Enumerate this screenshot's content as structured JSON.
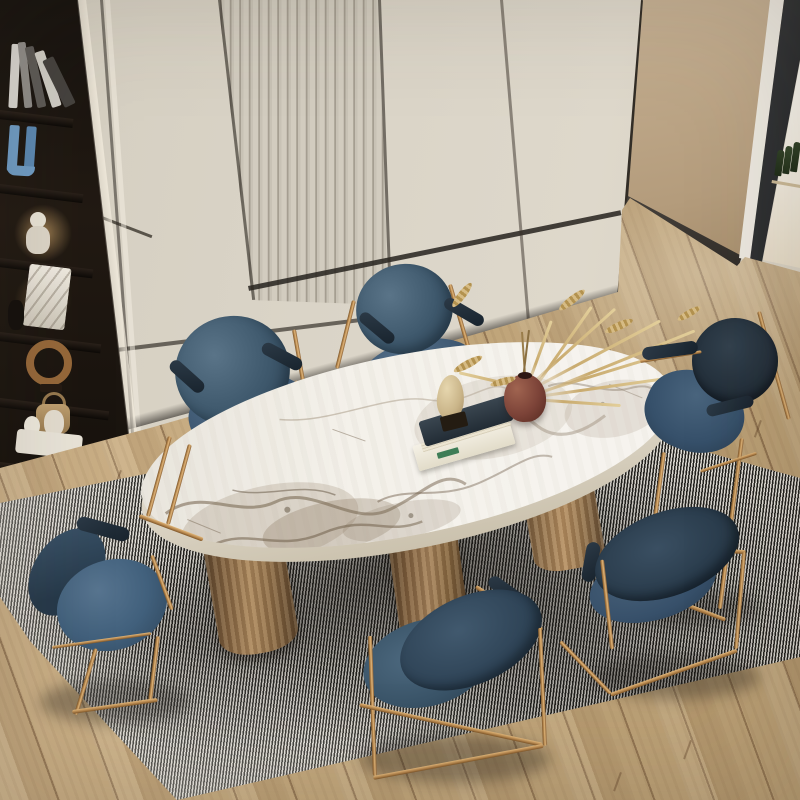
{
  "meta": {
    "title": "Dining room with oval marble table, brass-framed blue velvet chairs, striped rug and cream cabinetry",
    "width": 800,
    "height": 800
  },
  "palette": {
    "cream_cabinet": "#d8d2c5",
    "fluted_light": "#d2ccbf",
    "fluted_dark": "#aaa396",
    "tan_wall": "#bfa789",
    "seam_dark": "#26221d",
    "wood_floor": "#c3a87d",
    "wood_seam": "#604228",
    "rug_light": "#e2dfd8",
    "rug_dark": "#24231f",
    "marble": "#f2efe8",
    "marble_vein": "#8d7b63",
    "brass": "#b5854c",
    "velvet_blue": "#3e586c",
    "velvet_navy": "#232f3a",
    "bronze_leg": "#8a6a45",
    "vase_brown": "#7c4338",
    "dried_grass": "#c9ab6f",
    "shelf_dark": "#1a1510",
    "bookend_blue": "#6f9cc4",
    "glass_frame": "#2c2e30"
  },
  "scene": {
    "wall": {
      "finish": "cream lacquer panels",
      "fluted_panel": true,
      "seams": "dark recessed lines"
    },
    "bookshelf": {
      "items": [
        "leaning books",
        "blue U bookend",
        "white bust with warm lamp glow",
        "veined marble box",
        "bronze ring sculpture",
        "woven basket",
        "white sculpture tray"
      ]
    },
    "glass_partition": {
      "bottles": 3,
      "position": "top right"
    },
    "floor": {
      "material": "light oak planks",
      "direction": "diagonal"
    },
    "rug": {
      "pattern": "black and white pinstripe",
      "shape": "rotated rectangle"
    },
    "table": {
      "shape": "oval",
      "top": "white marble with taupe veining",
      "legs": 3,
      "leg_material": "brushed bronze cylinders",
      "decor": [
        "stack of books",
        "egg sculpture on black base",
        "round brown vase",
        "dried pampas grass",
        "loose wheat spikes"
      ]
    },
    "chairs": {
      "count": 6,
      "upholstery": "slate blue velvet",
      "frame": "brass sled base",
      "armrest_pads": "navy leather"
    }
  }
}
